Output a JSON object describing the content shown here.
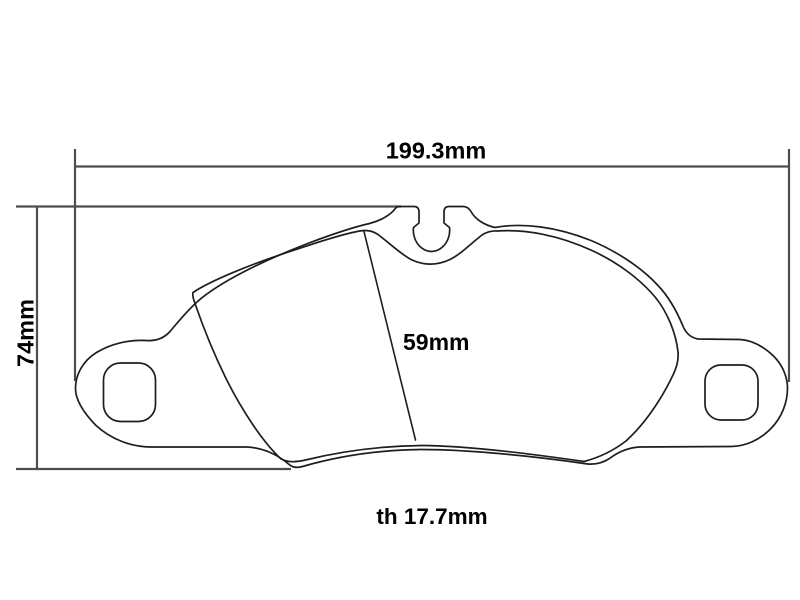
{
  "page": {
    "background": "#ffffff"
  },
  "drawing": {
    "kind": "brake-pad-technical-drawing",
    "labels": {
      "overall_width": "199.3mm",
      "overall_height": "74mm",
      "friction_height": "59mm",
      "thickness": "th 17.7mm"
    },
    "values": {
      "overall_width_mm": 199.3,
      "overall_height_mm": 74,
      "friction_height_mm": 59,
      "thickness_mm": 17.7
    },
    "colors": {
      "outline": "#1e1e1e",
      "dimension_line": "#4d4d4d",
      "label_text": "#000000"
    }
  }
}
